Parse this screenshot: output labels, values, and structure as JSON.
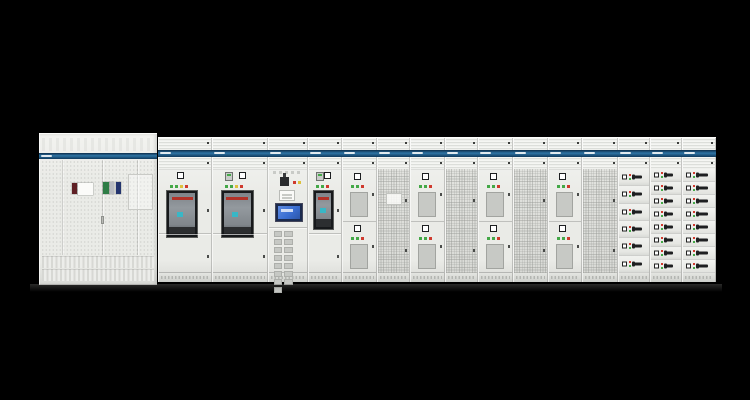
{
  "scene": {
    "subject": "low-voltage-switchgear-lineup-photo",
    "background": "black"
  },
  "palette": {
    "bg": "#000000",
    "body": "#eaebe7",
    "body_hi": "#f4f5f2",
    "body_lo": "#d9dad6",
    "slat": "#dcdeda",
    "band_top": "#0d2d4a",
    "band_mid": "#2e74a4",
    "band_bot": "#10395c",
    "led_green": "#43a847",
    "led_red": "#cf3a2e",
    "led_yellow": "#ddc13d",
    "acb_frame": "#17191b",
    "acb_body": "#93999e",
    "acb_red": "#b23228",
    "acb_cyan": "#39b7c6",
    "hmi_frame": "#1b2a4d",
    "hmi_screen": "#3a6ed2",
    "handle": "#1e1f21",
    "plinth_dot": "#b4b6b2",
    "perf": "#d2d3cf"
  },
  "left_cabinet": {
    "id": "distribution-left",
    "type": "perforated-double-door",
    "band_label_legible": false,
    "items": [
      {
        "name": "maroon-component",
        "color": "#5e1f24",
        "x": 33,
        "y": 49,
        "w": 5,
        "h": 11
      },
      {
        "name": "white-label",
        "color": "#fbfbf9",
        "x": 39,
        "y": 49,
        "w": 15,
        "h": 12
      },
      {
        "name": "green-component",
        "color": "#2e7d46",
        "x": 64,
        "y": 48,
        "w": 6,
        "h": 12
      },
      {
        "name": "grey-component",
        "color": "#b9bcc2",
        "x": 71,
        "y": 48,
        "w": 4,
        "h": 12
      },
      {
        "name": "blue-component",
        "color": "#24356e",
        "x": 77,
        "y": 48,
        "w": 5,
        "h": 12
      }
    ],
    "seams_x": [
      23,
      63,
      98
    ],
    "handle_seam_index": 1
  },
  "cabinets": [
    {
      "id": "acb-1",
      "type": "acb",
      "w": 54,
      "has_meter": false,
      "win_h": 46,
      "leds": [
        "green",
        "green",
        "yellow",
        "red"
      ]
    },
    {
      "id": "acb-2",
      "type": "acb",
      "w": 56,
      "has_meter": true,
      "win_h": 46,
      "leds": [
        "green",
        "green",
        "yellow",
        "red"
      ]
    },
    {
      "id": "control-hmi",
      "type": "control",
      "w": 40,
      "term_rows": 5,
      "term_cols": 3
    },
    {
      "id": "acb-3",
      "type": "acb",
      "w": 34,
      "has_meter": true,
      "win_h": 38,
      "leds": [
        "green",
        "green",
        "red"
      ]
    },
    {
      "id": "feeder-1",
      "type": "feeder",
      "w": 35,
      "modules": 2,
      "leds": [
        "green",
        "green",
        "red"
      ]
    },
    {
      "id": "mesh-1",
      "type": "mesh",
      "w": 33,
      "filter_label": true
    },
    {
      "id": "feeder-2",
      "type": "feeder",
      "w": 35,
      "modules": 2,
      "leds": [
        "green",
        "green",
        "red"
      ]
    },
    {
      "id": "mesh-2",
      "type": "mesh",
      "w": 33,
      "filter_label": false
    },
    {
      "id": "feeder-3",
      "type": "feeder",
      "w": 35,
      "modules": 2,
      "leds": [
        "green",
        "green",
        "red"
      ]
    },
    {
      "id": "mesh-3",
      "type": "mesh",
      "w": 35,
      "filter_label": false
    },
    {
      "id": "feeder-4",
      "type": "feeder",
      "w": 34,
      "modules": 2,
      "leds": [
        "green",
        "green",
        "red"
      ]
    },
    {
      "id": "mesh-4",
      "type": "mesh",
      "w": 36,
      "filter_label": false
    },
    {
      "id": "drawers-a",
      "type": "drawers",
      "w": 32,
      "rows": 6,
      "variant": "wide",
      "handle_w": 9
    },
    {
      "id": "drawers-b",
      "type": "drawers",
      "w": 32,
      "rows": 8,
      "variant": "slim",
      "handle_w": 8
    },
    {
      "id": "drawers-c",
      "type": "drawers",
      "w": 34,
      "rows": 8,
      "variant": "bold",
      "handle_w": 11
    }
  ]
}
